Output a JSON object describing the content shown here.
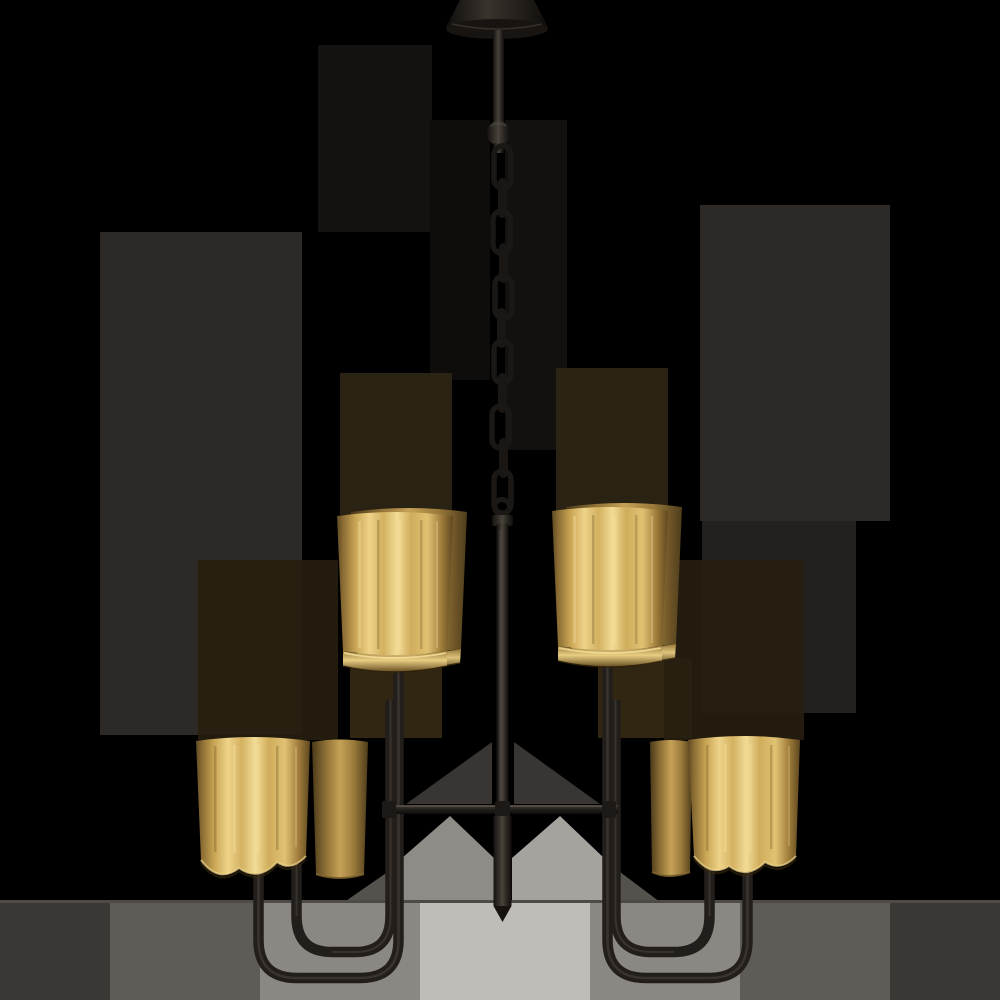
{
  "scene": {
    "subject": "two-tier four-arm chandelier with doubled brass cylinder shades and dark bronze frame hanging from a chain",
    "shade_groups": 4,
    "shades_per_group": 2,
    "chain_links": 11,
    "background_style": "black with gray rectangular transparency artifacts and light gray band at bottom"
  },
  "colors": {
    "background": "#000000",
    "metal": "#221e1b",
    "metal_highlight": "#756c62",
    "brass_light": "#f2dc96",
    "brass_mid": "#d0ad5c",
    "brass_dark": "#5e481f",
    "artifact_gray_dark": "#2c2926",
    "artifact_gray_mid": "#8b8783",
    "artifact_gray_light": "#c0bcb8"
  },
  "parts": [
    "ceiling-canopy",
    "hanging-rod",
    "coupler-knob",
    "chain",
    "chain-loop",
    "center-column",
    "column-finial",
    "crossbar",
    "left-outer-arm",
    "left-inner-arm",
    "right-outer-arm",
    "right-inner-arm",
    "upper-left-shades",
    "upper-right-shades",
    "lower-left-shades",
    "lower-right-shades"
  ]
}
